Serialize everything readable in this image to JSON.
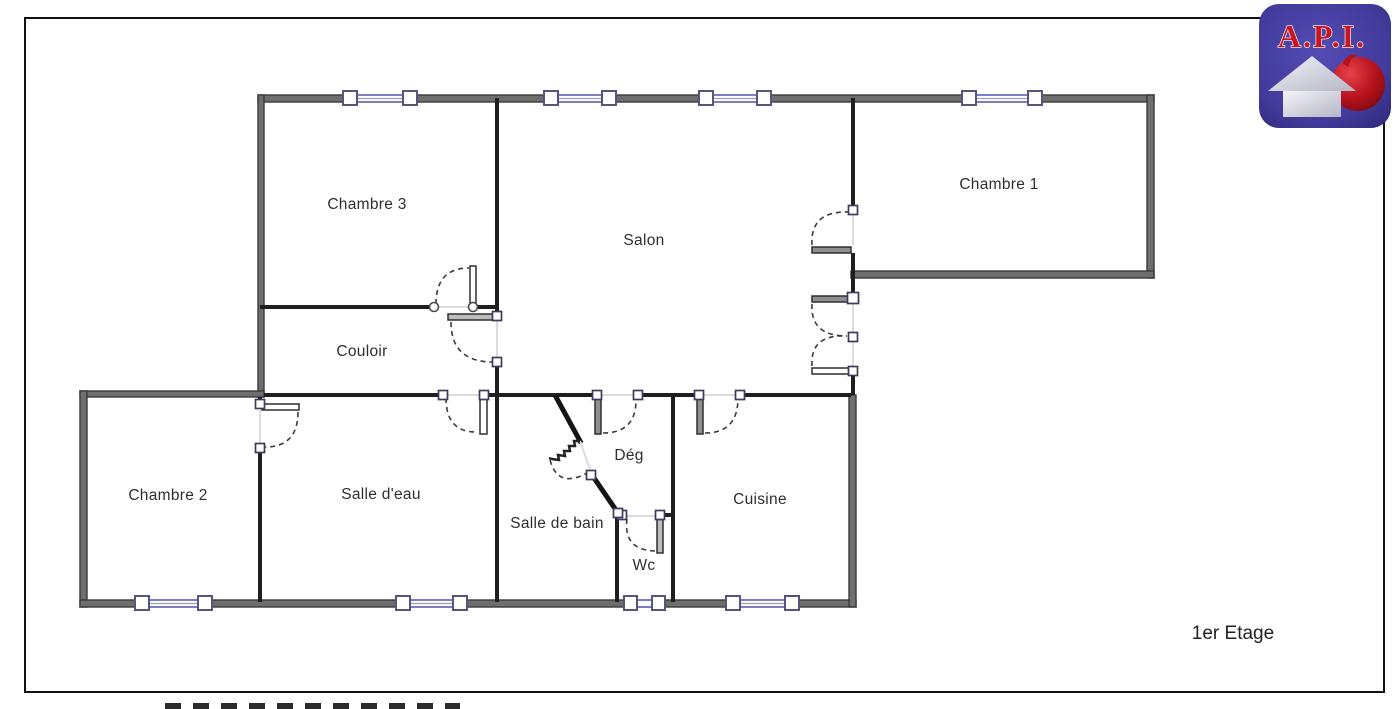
{
  "floor": {
    "label": "1er Etage"
  },
  "logo": {
    "text": "A.P.I."
  },
  "rooms": {
    "chambre3": "Chambre 3",
    "salon": "Salon",
    "chambre1": "Chambre 1",
    "couloir": "Couloir",
    "chambre2": "Chambre 2",
    "salle_deau": "Salle d'eau",
    "salle_de_bain": "Salle de bain",
    "deg": "Dég",
    "wc": "Wc",
    "cuisine": "Cuisine"
  },
  "colors": {
    "wall_exterior": "#6e6e6e",
    "wall_edge": "#3a3a3a",
    "wall_interior": "#1f1f1f",
    "window_blue": "#7d7dc4",
    "page_border": "#111111",
    "logo_purple": "#423b9c",
    "logo_red": "#c8161e",
    "label_text": "#2e2e2e"
  }
}
